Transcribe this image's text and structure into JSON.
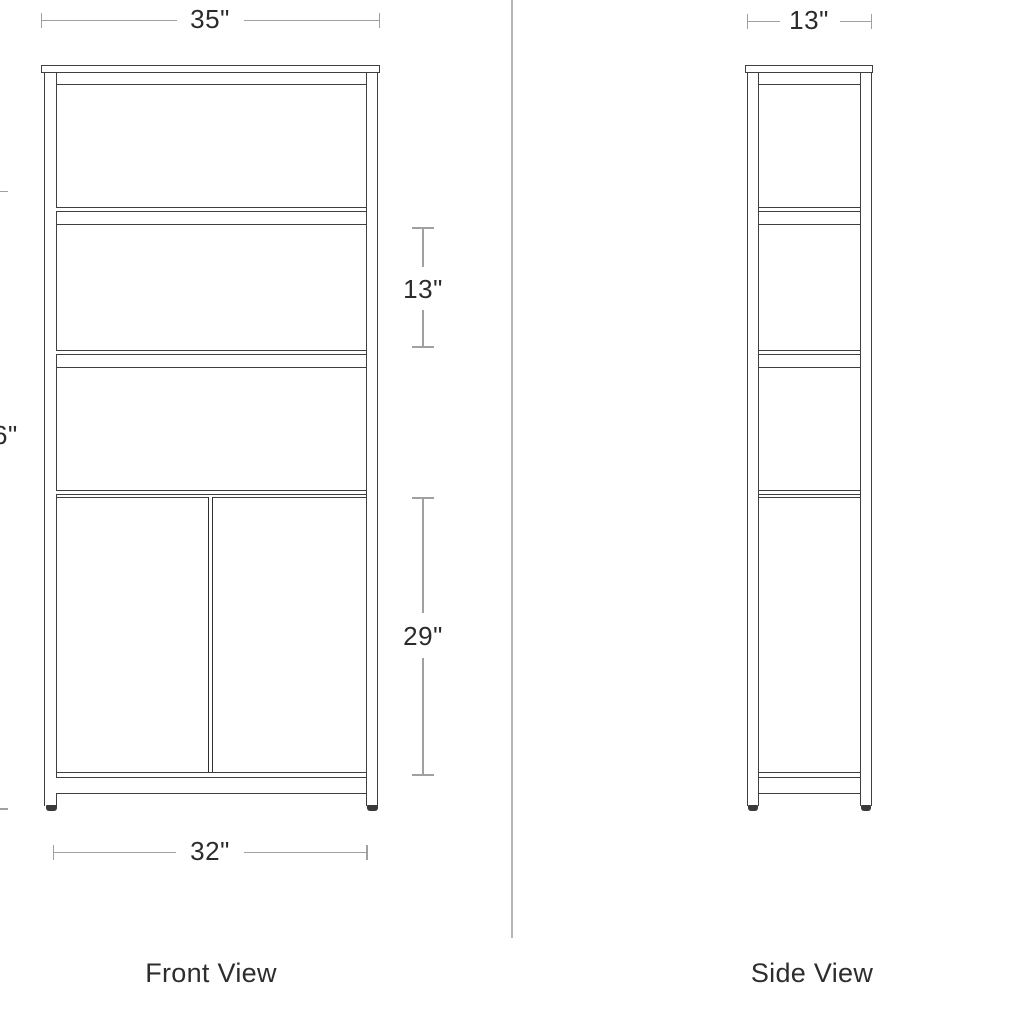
{
  "diagram_title": "furniture-dimension-diagram",
  "views": {
    "front": {
      "label": "Front View",
      "dimensions": {
        "top_width": "35\"",
        "shelf_spacing": "13\"",
        "cabinet_height": "29\"",
        "bottom_width": "32\"",
        "left_height_partial": "6\""
      }
    },
    "side": {
      "label": "Side View",
      "dimensions": {
        "depth": "13\""
      }
    }
  },
  "colors": {
    "background": "#ffffff",
    "outline": "#3f3f3f",
    "outline_bold": "#303030",
    "dimension_line": "#a0a0a0",
    "label_text": "#2d2d2d",
    "divider_line": "#b5b5b5"
  }
}
